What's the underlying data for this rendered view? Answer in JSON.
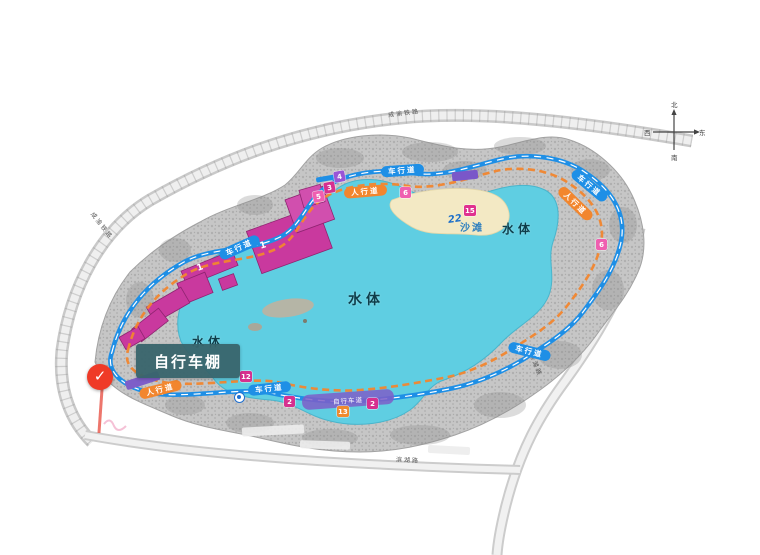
{
  "map": {
    "tooltip_label": "自行车棚",
    "water_label": "水体",
    "beach_label": "沙滩",
    "vehicle_path_label": "车行道",
    "pedestrian_path_label": "人行道",
    "cycle_band_label": "自行车道",
    "point_number": "22",
    "badges": [
      "5",
      "3",
      "4",
      "6",
      "15",
      "6",
      "2",
      "2",
      "13",
      "12"
    ],
    "building_numbers": [
      "1",
      "1"
    ],
    "roads": {
      "top": "成渝铁路",
      "left": "成渝铁路",
      "right": "滨湖路",
      "bottom": "滨湖路"
    },
    "compass": {
      "north": "北",
      "south": "南",
      "west": "西",
      "east": "东"
    },
    "marker": {
      "check_icon": "✓"
    },
    "colors": {
      "lake": "#5FCEE2",
      "buildings": "#C9399E",
      "vehicle_path": "#1E8FE6",
      "pedestrian_path": "#F2862E",
      "cycle_band": "#7E5EC8",
      "beach": "#F3E9C4",
      "marker_red": "#EF3A27",
      "tooltip_bg": "#3A666C"
    }
  }
}
